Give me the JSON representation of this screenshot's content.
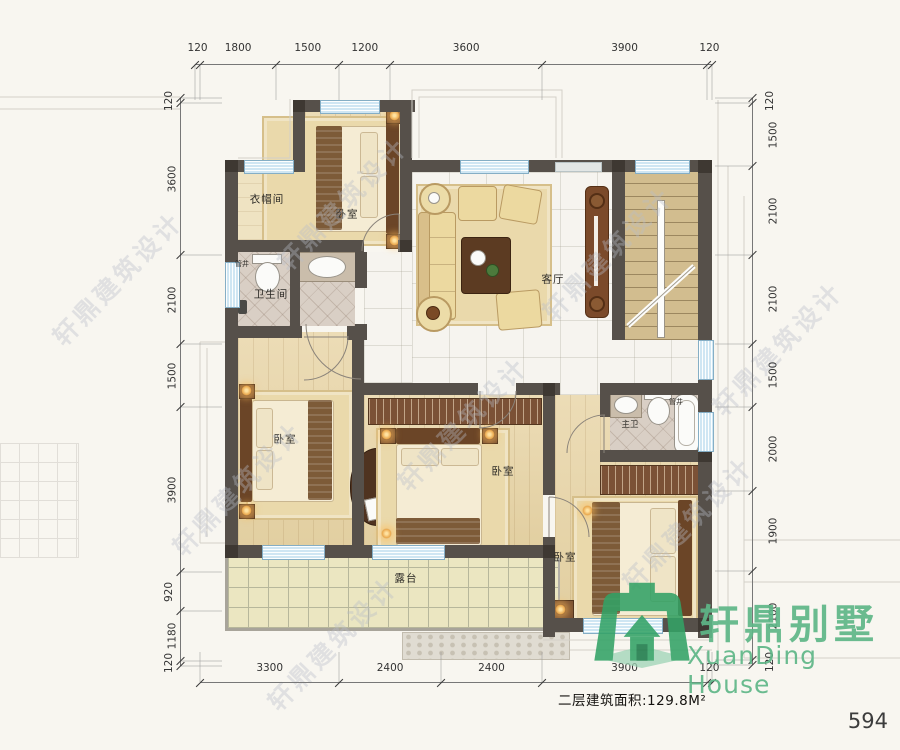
{
  "page": {
    "number": "594"
  },
  "plan": {
    "labels": {
      "cloakroom": "衣帽间",
      "bedroom": "卧室",
      "bathroom": "卫生间",
      "living": "客厅",
      "master_bath": "主卫",
      "shaft": "管井",
      "terrace": "露台"
    },
    "area_note": "二层建筑面积:129.8M²",
    "dimensions": {
      "top": [
        "120",
        "1800",
        "1500",
        "1200",
        "3600",
        "3900",
        "120"
      ],
      "left": [
        "120",
        "3600",
        "2100",
        "1500",
        "3900",
        "920",
        "1180",
        "120"
      ],
      "right": [
        "120",
        "1500",
        "2100",
        "2100",
        "1500",
        "2000",
        "1900",
        "2100",
        "120"
      ],
      "bottom": [
        "3300",
        "2400",
        "2400",
        "3900",
        "120"
      ]
    }
  },
  "watermark": {
    "text": "轩鼎建筑设计"
  },
  "logo": {
    "zh": "轩鼎别墅",
    "en": "XuanDing House",
    "color": "#5eb687"
  },
  "colors": {
    "wall": "#56504a",
    "window": "#cfe6f3",
    "wood_floor": "#e8d7ae",
    "marble_floor": "#f6f4ef",
    "terrace_floor": "#ebe6c1",
    "logo_green": "#3aa468"
  }
}
